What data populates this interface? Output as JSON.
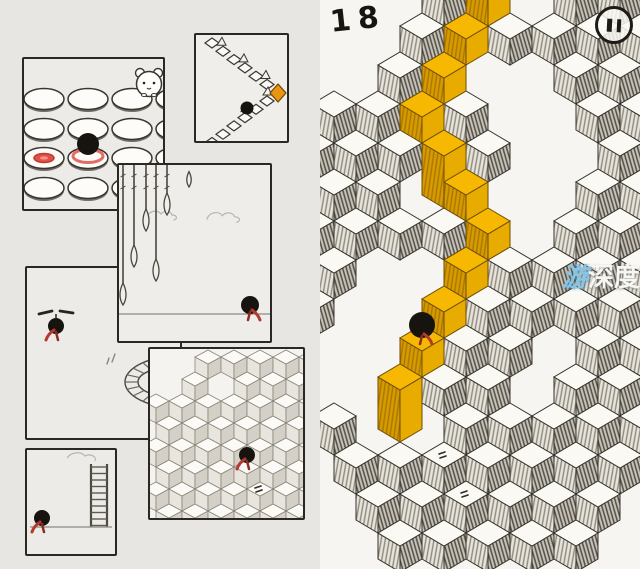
{
  "hud": {
    "level_number": "18"
  },
  "watermark": {
    "char_blue": "游",
    "chars_white": "深度"
  },
  "colors": {
    "paper_left": "#e8e6e3",
    "paper_right": "#f7f5f1",
    "ink": "#34312b",
    "path_yellow_top": "#F7B801",
    "path_yellow_left": "#D79B00",
    "path_yellow_right": "#E8AB00",
    "scarf_red": "#B23A2E",
    "scarf_red_dark": "#8F2B22",
    "highlight_red": "#E05248",
    "goal_orange": "#E8960F"
  },
  "right_scene": {
    "cube": {
      "half_w": 22,
      "half_h": 13,
      "depth": 26,
      "row_step": 39,
      "col_step": 44,
      "rows": 15
    },
    "path_cells": [
      [
        168,
        -13
      ],
      [
        146,
        26
      ],
      [
        124,
        65
      ],
      [
        102,
        104
      ],
      [
        124,
        143
      ],
      [
        146,
        182
      ],
      [
        168,
        221
      ],
      [
        146,
        260
      ],
      [
        124,
        299
      ],
      [
        102,
        338
      ],
      [
        80,
        377
      ]
    ],
    "tall_cells": [
      [
        124,
        143
      ],
      [
        80,
        377
      ]
    ],
    "holes": [
      [
        -8,
        -13
      ],
      [
        36,
        -13
      ],
      [
        80,
        -13
      ],
      [
        212,
        -13
      ],
      [
        14,
        26
      ],
      [
        58,
        26
      ],
      [
        -8,
        65
      ],
      [
        36,
        65
      ],
      [
        168,
        65
      ],
      [
        212,
        65
      ],
      [
        190,
        104
      ],
      [
        234,
        104
      ],
      [
        212,
        143
      ],
      [
        256,
        143
      ],
      [
        102,
        182
      ],
      [
        190,
        182
      ],
      [
        234,
        182
      ],
      [
        212,
        221
      ],
      [
        58,
        260
      ],
      [
        102,
        260
      ],
      [
        36,
        299
      ],
      [
        80,
        299
      ],
      [
        14,
        338
      ],
      [
        58,
        338
      ],
      [
        234,
        338
      ],
      [
        -8,
        377
      ],
      [
        36,
        377
      ],
      [
        212,
        377
      ],
      [
        58,
        416
      ],
      [
        102,
        416
      ],
      [
        -8,
        455
      ],
      [
        14,
        494
      ],
      [
        322,
        494
      ],
      [
        -8,
        533
      ],
      [
        36,
        533
      ],
      [
        300,
        533
      ]
    ],
    "marked_cells": [
      [
        124,
        455
      ],
      [
        146,
        494
      ]
    ],
    "ball": {
      "cell": [
        102,
        338
      ],
      "center": [
        102,
        325
      ],
      "r": 13
    }
  },
  "left_scenes": {
    "discs": {
      "grid_cols": [
        20,
        64,
        108,
        152
      ],
      "grid_rows": [
        40,
        70,
        99,
        129
      ],
      "ball_at": [
        64,
        85
      ],
      "red_ring_at": [
        64,
        97
      ],
      "red_spot_at": [
        20,
        99
      ],
      "hamster_at": [
        125,
        25
      ]
    },
    "zigzag": {
      "ball_at": [
        51,
        73
      ],
      "goal_diamond_at": [
        82,
        58
      ]
    },
    "spears": {
      "spears": [
        [
          4,
          120
        ],
        [
          15,
          82
        ],
        [
          27,
          46
        ],
        [
          37,
          96
        ],
        [
          48,
          30
        ]
      ],
      "loose_tip_at": [
        70,
        8
      ],
      "ground_y": 149,
      "ball_at": [
        131,
        140
      ]
    },
    "helicopter": {
      "figure_at": [
        29,
        58
      ],
      "loop_center": [
        152,
        114
      ]
    },
    "mini_cubes": {
      "cube": {
        "half_w": 13,
        "half_h": 7,
        "depth": 15,
        "row_step": 22,
        "col_step": 26,
        "rows": 9
      },
      "holes": [
        [
          6,
          8
        ],
        [
          32,
          8
        ],
        [
          19,
          30
        ],
        [
          71,
          30
        ]
      ],
      "ball_cell": [
        97,
        118
      ],
      "ball_center": [
        97,
        106
      ],
      "marked_cell": [
        110,
        140
      ]
    },
    "ladder": {
      "ladder_x": [
        64,
        80
      ],
      "ladder_top": 14,
      "ground_y": 77,
      "ball_at": [
        15,
        68
      ]
    }
  }
}
